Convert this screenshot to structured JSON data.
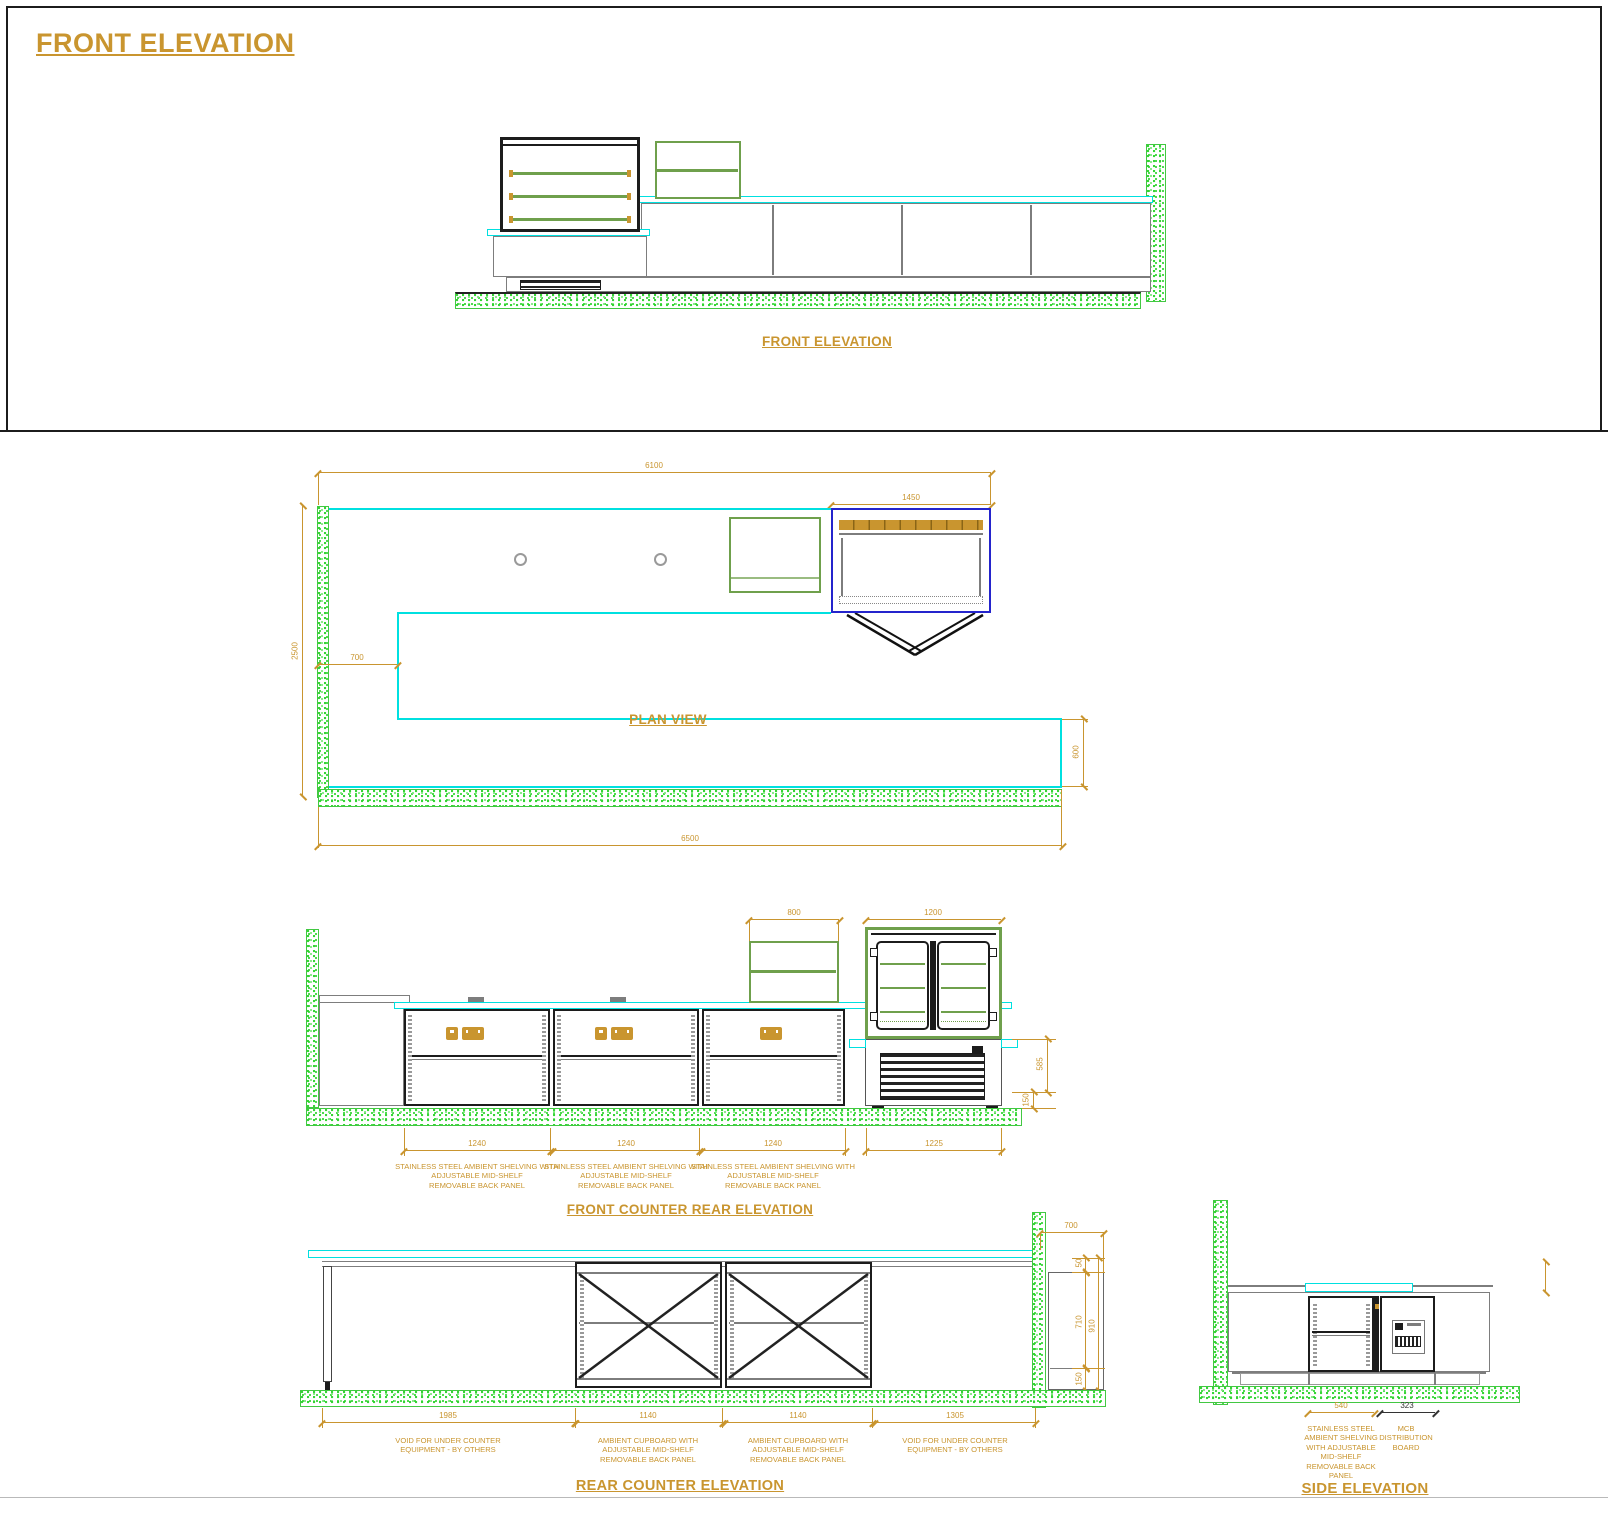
{
  "page": {
    "title": "FRONT ELEVATION"
  },
  "colors": {
    "gold": "#C9952F",
    "cyan": "#00E0E0",
    "green": "#3FD63F",
    "olive": "#6FA04C",
    "blue": "#2424CC",
    "dark": "#1c1c1c"
  },
  "front_elevation": {
    "label": "FRONT ELEVATION"
  },
  "plan_view": {
    "label": "PLAN VIEW",
    "dims": {
      "overall_top": "6100",
      "display_case": "1450",
      "depth_left": "2500",
      "counter_depth": "700",
      "rear_depth": "600",
      "overall_bottom": "6500"
    }
  },
  "front_counter_rear_elevation": {
    "title": "FRONT COUNTER REAR ELEVATION",
    "dims": {
      "shelf_unit": "800",
      "display_case_width_top": "1200",
      "case_base_height": "585",
      "plinth_height": "150",
      "bay1": "1240",
      "bay2": "1240",
      "bay3": "1240",
      "case_width": "1225"
    },
    "notes": {
      "bay": "STAINLESS STEEL AMBIENT SHELVING WITH\nADJUSTABLE MID-SHELF\nREMOVABLE BACK PANEL"
    }
  },
  "rear_counter_elevation": {
    "title": "REAR COUNTER ELEVATION",
    "dims": {
      "top_right": "700",
      "void_left": "1985",
      "cupboard1": "1140",
      "cupboard2": "1140",
      "void_right": "1305",
      "top_gap": "50",
      "underside": "710",
      "plinth": "150",
      "overall_height": "910"
    },
    "notes": {
      "void": "VOID FOR UNDER COUNTER\nEQUIPMENT - BY OTHERS",
      "cupboard": "AMBIENT CUPBOARD WITH\nADJUSTABLE MID-SHELF\nREMOVABLE BACK PANEL"
    }
  },
  "side_elevation": {
    "title": "SIDE ELEVATION",
    "dims": {
      "shelving": "540",
      "mcb": "323"
    },
    "notes": {
      "shelving": "STAINLESS STEEL\nAMBIENT SHELVING\nWITH ADJUSTABLE\nMID-SHELF\nREMOVABLE BACK\nPANEL",
      "mcb": "MCB\nDISTRIBUTION\nBOARD"
    }
  }
}
